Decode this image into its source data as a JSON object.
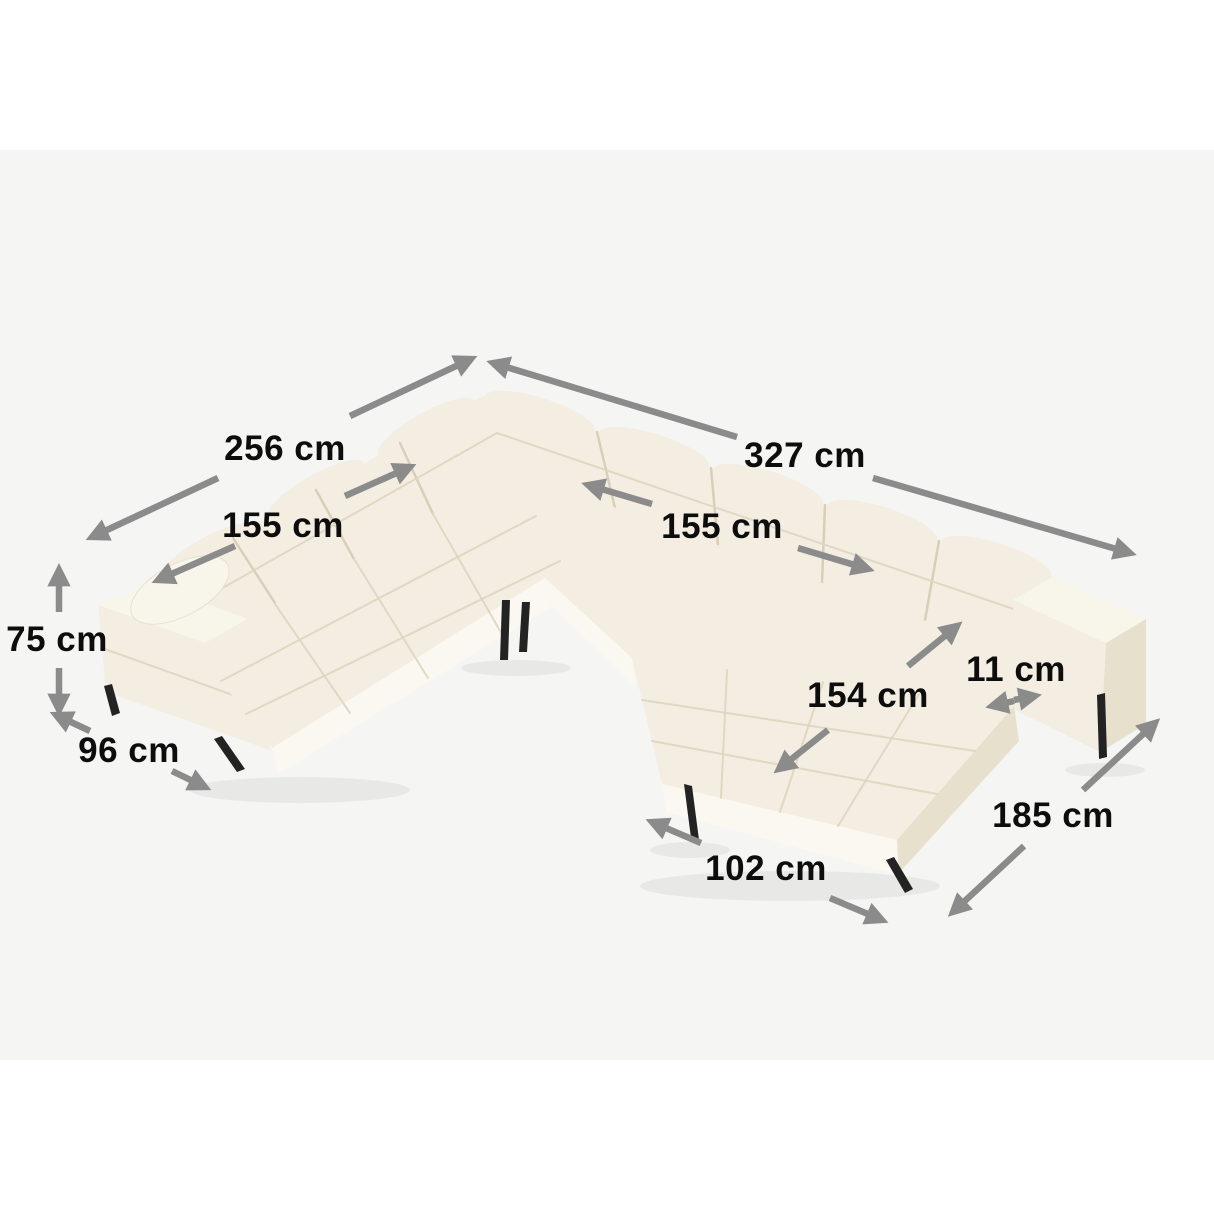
{
  "meta": {
    "type": "product-dimension-diagram",
    "subject": "U-shaped corner sectional sofa with chaise, biscuit-tufted light beige upholstery, black metal legs"
  },
  "colors": {
    "page-bg": "#ffffff",
    "panel-bg": "#f5f5f3",
    "arrow": "#8b8b8b",
    "label-text": "#0d0d0d",
    "sofa-main": "#f3eee1",
    "sofa-light": "#f8f5eb",
    "sofa-dark": "#e7e0cd",
    "sofa-base": "#faf8f1",
    "sofa-crease": "#ded5c0",
    "sofa-divider": "#d8cfb8",
    "leg": "#232323"
  },
  "labels": {
    "width_left": "256 cm",
    "width_right": "327 cm",
    "seat_width_left": "155 cm",
    "seat_width_right": "155 cm",
    "chaise_seat_length": "154 cm",
    "armrest_width": "11 cm",
    "height": "75 cm",
    "depth_left": "96 cm",
    "side_depth_right": "185 cm",
    "chaise_width": "102 cm"
  }
}
